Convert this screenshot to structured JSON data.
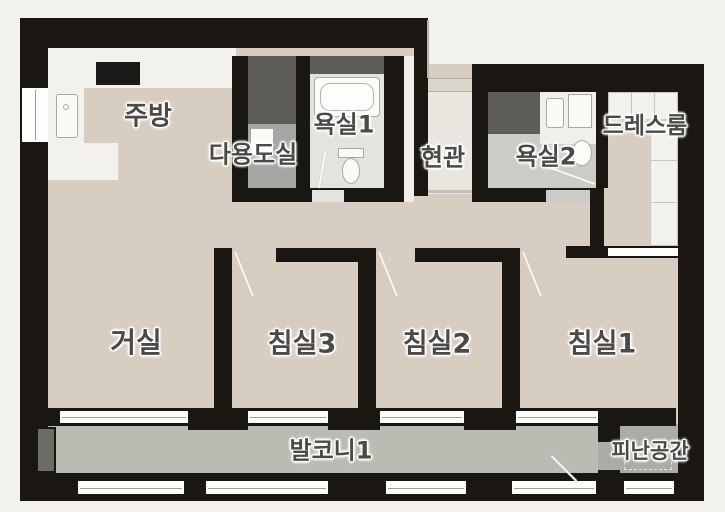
{
  "plan_title": "apartment-floor-plan",
  "rooms": [
    {
      "id": "kitchen",
      "label": "주방"
    },
    {
      "id": "utility",
      "label": "다용도실"
    },
    {
      "id": "bath1",
      "label": "욕실1"
    },
    {
      "id": "entry",
      "label": "현관"
    },
    {
      "id": "bath2",
      "label": "욕실2"
    },
    {
      "id": "dressroom",
      "label": "드레스룸"
    },
    {
      "id": "living",
      "label": "거실"
    },
    {
      "id": "bed3",
      "label": "침실3"
    },
    {
      "id": "bed2",
      "label": "침실2"
    },
    {
      "id": "bed1",
      "label": "침실1"
    },
    {
      "id": "balcony",
      "label": "발코니1"
    },
    {
      "id": "refuge",
      "label": "피난공간"
    }
  ],
  "colors": {
    "wall": "#1a1713",
    "background": "#f2f1ee",
    "room_floor": "#d7cdc0",
    "balcony_floor": "#b9bcb3",
    "refuge_floor": "#aaada5",
    "bath1_floor": "#e3e3df",
    "bath2_floor": "#cbccc8",
    "utility_floor": "#a4a7a3",
    "entry_floor": "#e9e6e0",
    "duct": "#5d5c58",
    "counter": "#f2f1ec",
    "label_text": "#4c4a47"
  }
}
